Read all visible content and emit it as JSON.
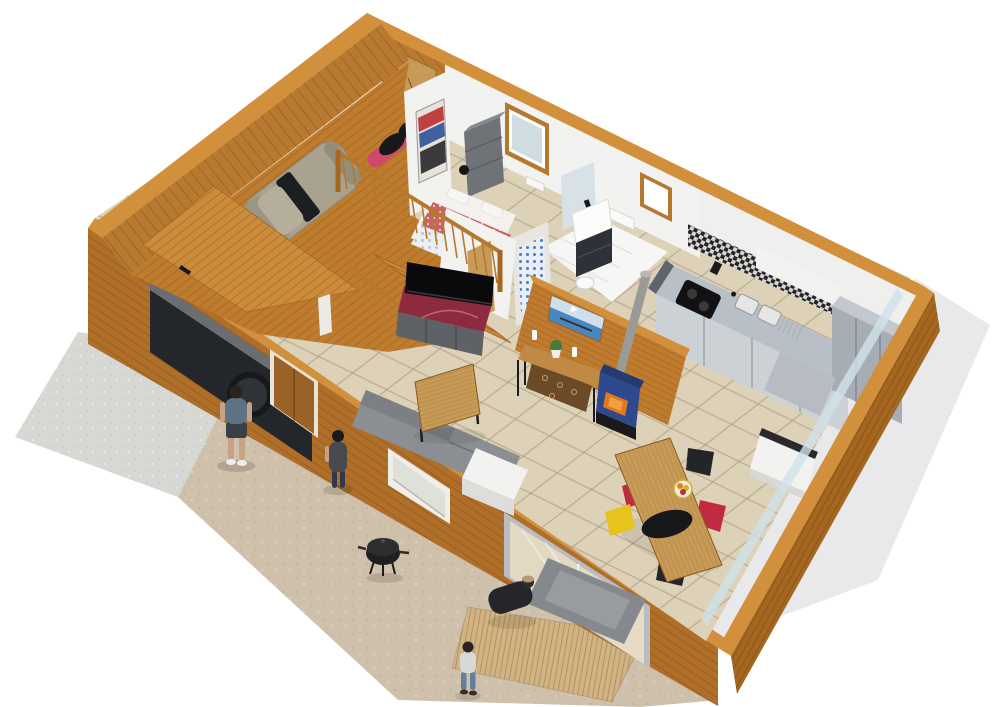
{
  "scene": {
    "description": "3D aerial cutaway rendering of a wooden chalet interior floor plan",
    "view": "bird's-eye perspective, walls cut open, white backdrop",
    "rooms": [
      {
        "name": "garage",
        "contents": [
          "car",
          "motorcycle",
          "loft-panel",
          "garage-door-opening"
        ]
      },
      {
        "name": "bedroom",
        "contents": [
          "double-bed",
          "wardrobe-shelf",
          "wall-poster",
          "wood-frame-window",
          "wall-lamp",
          "radiator"
        ]
      },
      {
        "name": "bathroom",
        "contents": [
          "vanity-with-mirror",
          "toilet",
          "blue-tile-shower",
          "wood-frame-window",
          "radiator"
        ]
      },
      {
        "name": "kitchen",
        "contents": [
          "counter-with-double-sink",
          "cooktop",
          "mosaic-backsplash",
          "tall-fridge-cabinet",
          "low-cabinet"
        ]
      },
      {
        "name": "living-room",
        "contents": [
          "staircase",
          "wood-railing",
          "tv",
          "tv-stand",
          "gray-sofa",
          "white-side-table",
          "lounge-chair",
          "coffee-table",
          "console-table",
          "firewood",
          "candles",
          "potted-plant",
          "sailboat-painting",
          "wood-stove",
          "stove-pipe"
        ]
      },
      {
        "name": "dining-area",
        "contents": [
          "wood-dining-table",
          "black-platter",
          "fruit-plate",
          "seven-chairs"
        ]
      }
    ],
    "exterior": [
      "concrete-driveway",
      "gravel-yard",
      "right-side-ground",
      "plank-deck-rug",
      "bbq-grill",
      "front-door",
      "window",
      "sliding-glass-door",
      "glass-wall"
    ],
    "people": [
      {
        "name": "man-standing",
        "location": "driveway"
      },
      {
        "name": "woman-standing",
        "location": "beside-front-wall"
      },
      {
        "name": "person-crouching",
        "location": "deck-rug"
      },
      {
        "name": "child-standing",
        "location": "yard"
      }
    ],
    "dining_chair_colors": [
      "#8a8f94",
      "#c22a42",
      "#e6c41c",
      "#232528",
      "#c22a42",
      "#e6c41c",
      "#232528"
    ]
  },
  "palette": {
    "bg": "#ffffff",
    "groundRight": "#e9e9eb",
    "concrete": "#d7d7d3",
    "gravel": "#cfc0ab",
    "deck": "#d2b384",
    "wallTop": "#d28f3c",
    "wallSW": "#b06f28",
    "wallNWInner": "#b87a30",
    "wallSE": "#a5661f",
    "garageMass": "#c07c2e",
    "loftPanel": "#cd8c3c",
    "tanDoor": "#c89a58",
    "floorTile": "#ddd2b8",
    "bathFloor": "#f6f6f4",
    "whiteWall": "#f2f2f1",
    "glass": "#cfe2ea",
    "frame": "#b9bcc0",
    "tv": "#0a0a0c",
    "tvTop": "#8e2a3e",
    "tvBody": "#5e6166",
    "sofa": "#8b8e92",
    "sofaBack": "#7c7f83",
    "whiteFurn": "#f2f2f0",
    "lounge": "#85888c",
    "woodLight": "#c79a56",
    "console": "#c08a45",
    "firewood": "#6b4a28",
    "stove": "#2e4a8e",
    "fire": "#e07820",
    "pipe": "#9a9a96",
    "counter": "#b9bfc6",
    "cabinet": "#ccd1d6",
    "tallUnit": "#a7adb4",
    "lowCab": "#b6bcc2",
    "chairRed": "#c22a42",
    "chairYellow": "#e6c41c",
    "chairBlack": "#232528",
    "chairGray": "#8a8f94",
    "bedRed": "#c86464",
    "bedWhite": "#f0eeea",
    "wardrobe": "#6f7276",
    "vanity": "#2e3238",
    "mirror": "#d7e2e8",
    "car": "#a8a28e",
    "moto": "#d0486a",
    "stairs": "#c8873a",
    "railing": "#b5782e",
    "painting": "#4a86c0",
    "skin": "#c9a184",
    "manShirt": "#5d7383",
    "darkCloth": "#24262b",
    "childHoodie": "#d9d9d3",
    "jeans": "#647e9e"
  }
}
